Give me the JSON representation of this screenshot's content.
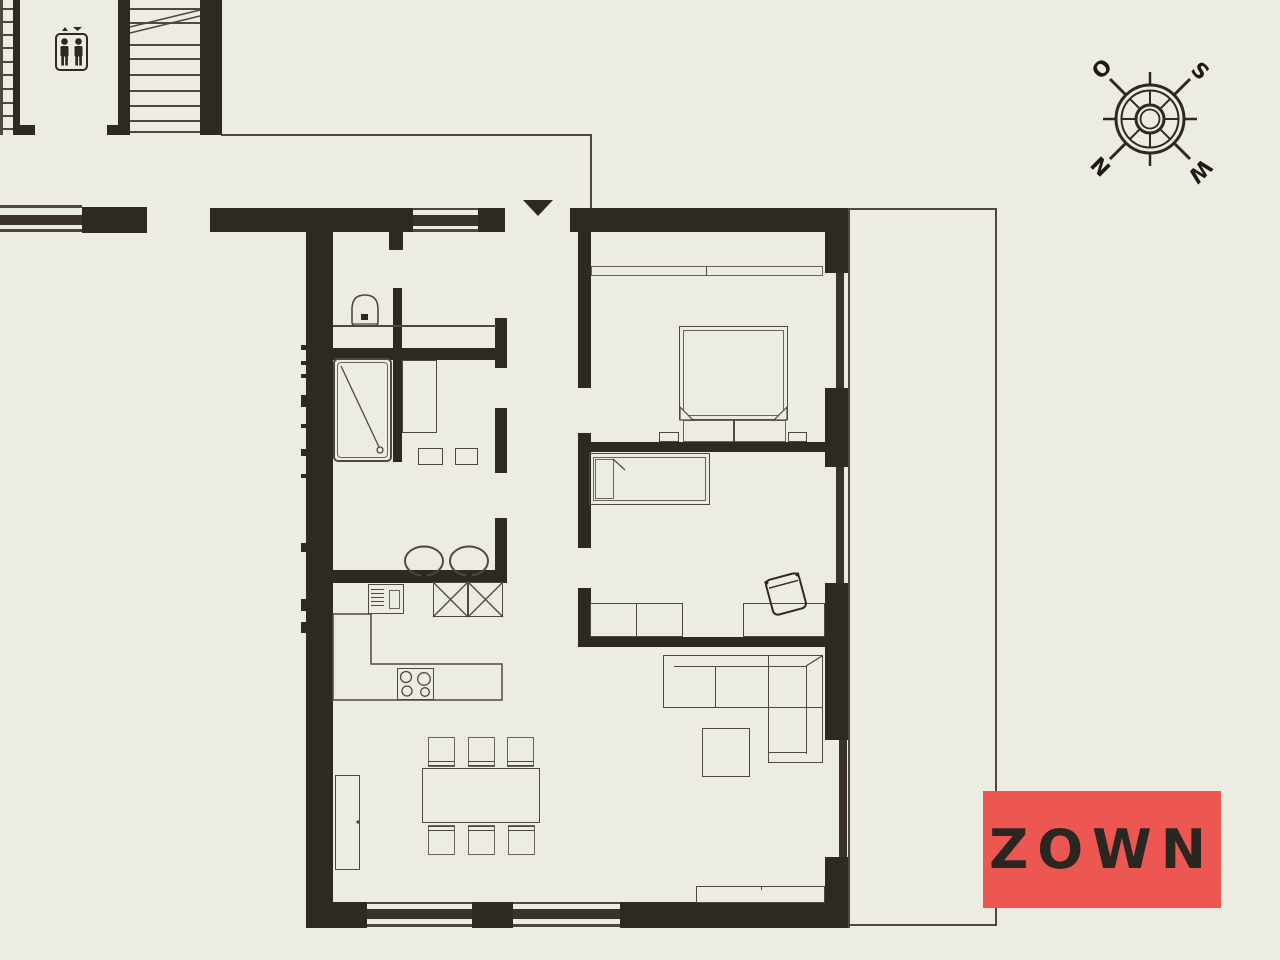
{
  "logo": {
    "text": "ZOWN",
    "background_color": "#ed5752",
    "text_color": "#2a2622"
  },
  "compass": {
    "letters": {
      "northwest": "O",
      "northeast": "S",
      "southwest": "N",
      "southeast": "W"
    }
  },
  "icons": {
    "elevator": "elevator-people-icon",
    "entrance": "entrance-direction-arrow",
    "compass": "compass-rose"
  },
  "colors": {
    "background": "#edece3",
    "walls": "#2e2923",
    "drawing_lines": "#4e4841",
    "accent_red": "#ed5752"
  }
}
